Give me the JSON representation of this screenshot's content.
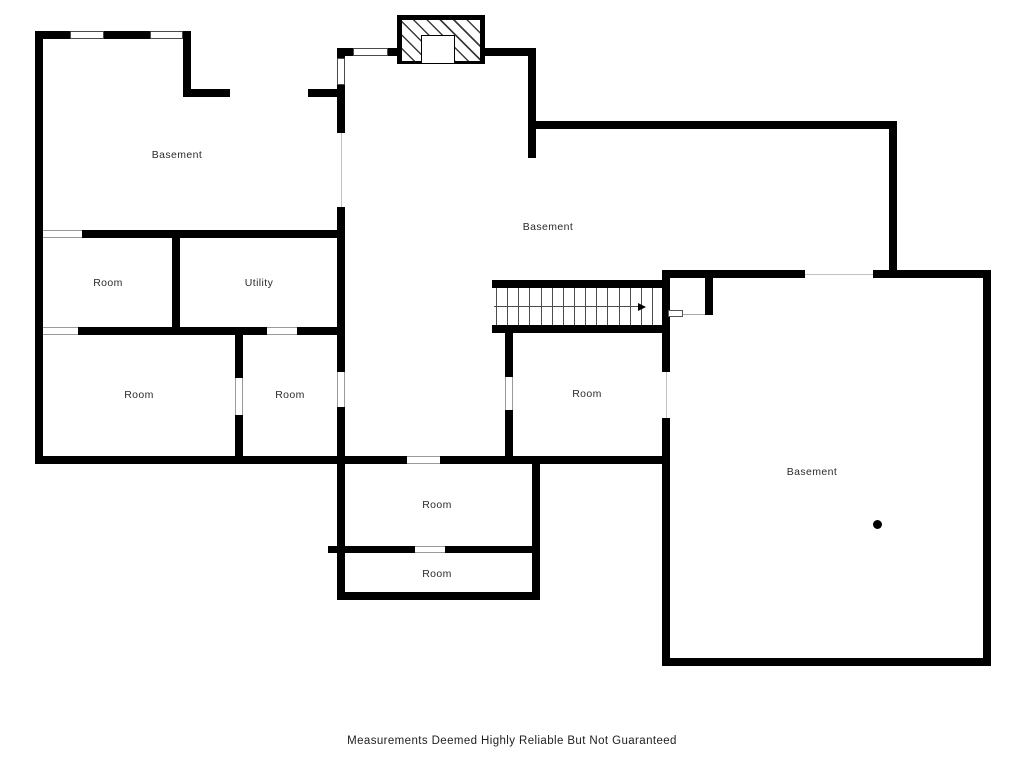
{
  "footer": {
    "text": "Measurements Deemed Highly Reliable But Not Guaranteed",
    "y": 735
  },
  "colors": {
    "wall": "#000000",
    "label": "#2b2b2b",
    "tread": "#4d4d4d"
  },
  "plan": {
    "labels": [
      {
        "text": "Basement",
        "x": 177,
        "y": 155
      },
      {
        "text": "Room",
        "x": 108,
        "y": 283
      },
      {
        "text": "Utility",
        "x": 259,
        "y": 283
      },
      {
        "text": "Room",
        "x": 139,
        "y": 395
      },
      {
        "text": "Room",
        "x": 290,
        "y": 395
      },
      {
        "text": "Basement",
        "x": 548,
        "y": 227
      },
      {
        "text": "Room",
        "x": 587,
        "y": 394
      },
      {
        "text": "Room",
        "x": 437,
        "y": 505
      },
      {
        "text": "Room",
        "x": 437,
        "y": 574
      },
      {
        "text": "Basement",
        "x": 812,
        "y": 472
      }
    ],
    "walls": [
      [
        35,
        31,
        35,
        8
      ],
      [
        104,
        31,
        46,
        8
      ],
      [
        183,
        31,
        8,
        8
      ],
      [
        35,
        31,
        8,
        433
      ],
      [
        183,
        31,
        8,
        66
      ],
      [
        183,
        89,
        47,
        8
      ],
      [
        308,
        89,
        37,
        8
      ],
      [
        337,
        48,
        8,
        10
      ],
      [
        337,
        85,
        8,
        48
      ],
      [
        337,
        207,
        8,
        165
      ],
      [
        337,
        407,
        8,
        193
      ],
      [
        337,
        48,
        16,
        8
      ],
      [
        388,
        48,
        9,
        8
      ],
      [
        485,
        48,
        43,
        8
      ],
      [
        528,
        48,
        8,
        110
      ],
      [
        528,
        121,
        369,
        8
      ],
      [
        889,
        121,
        8,
        157
      ],
      [
        662,
        270,
        143,
        8
      ],
      [
        873,
        270,
        118,
        8
      ],
      [
        983,
        270,
        8,
        396
      ],
      [
        662,
        658,
        329,
        8
      ],
      [
        662,
        270,
        8,
        102
      ],
      [
        662,
        418,
        8,
        248
      ],
      [
        705,
        278,
        8,
        37
      ],
      [
        492,
        280,
        170,
        8
      ],
      [
        492,
        325,
        178,
        8
      ],
      [
        505,
        333,
        8,
        44
      ],
      [
        505,
        410,
        8,
        54
      ],
      [
        35,
        456,
        372,
        8
      ],
      [
        440,
        456,
        230,
        8
      ],
      [
        82,
        230,
        263,
        8
      ],
      [
        172,
        238,
        8,
        96
      ],
      [
        78,
        327,
        189,
        8
      ],
      [
        297,
        327,
        48,
        8
      ],
      [
        235,
        335,
        8,
        43
      ],
      [
        235,
        415,
        8,
        41
      ],
      [
        532,
        464,
        8,
        136
      ],
      [
        328,
        546,
        9,
        7
      ],
      [
        345,
        546,
        70,
        7
      ],
      [
        445,
        546,
        87,
        7
      ],
      [
        337,
        592,
        203,
        8
      ]
    ],
    "openings": [
      {
        "x": 70,
        "y": 31,
        "w": 34,
        "h": 8,
        "kind": "window",
        "dir": "h"
      },
      {
        "x": 150,
        "y": 31,
        "w": 33,
        "h": 8,
        "kind": "window",
        "dir": "h"
      },
      {
        "x": 353,
        "y": 48,
        "w": 35,
        "h": 8,
        "kind": "window",
        "dir": "h"
      },
      {
        "x": 337,
        "y": 58,
        "w": 8,
        "h": 27,
        "kind": "window",
        "dir": "v"
      },
      {
        "x": 337,
        "y": 133,
        "w": 8,
        "h": 74,
        "kind": "line",
        "dir": "v"
      },
      {
        "x": 337,
        "y": 372,
        "w": 8,
        "h": 35,
        "kind": "door",
        "dir": "v"
      },
      {
        "x": 805,
        "y": 270,
        "w": 68,
        "h": 8,
        "kind": "line",
        "dir": "h"
      },
      {
        "x": 662,
        "y": 372,
        "w": 8,
        "h": 46,
        "kind": "line",
        "dir": "v"
      },
      {
        "x": 505,
        "y": 377,
        "w": 8,
        "h": 33,
        "kind": "door",
        "dir": "v"
      },
      {
        "x": 407,
        "y": 456,
        "w": 33,
        "h": 8,
        "kind": "door",
        "dir": "h"
      },
      {
        "x": 43,
        "y": 230,
        "w": 39,
        "h": 8,
        "kind": "door",
        "dir": "h"
      },
      {
        "x": 43,
        "y": 327,
        "w": 35,
        "h": 8,
        "kind": "door",
        "dir": "h"
      },
      {
        "x": 267,
        "y": 327,
        "w": 30,
        "h": 8,
        "kind": "door",
        "dir": "h"
      },
      {
        "x": 235,
        "y": 378,
        "w": 8,
        "h": 37,
        "kind": "door",
        "dir": "v"
      },
      {
        "x": 415,
        "y": 546,
        "w": 30,
        "h": 7,
        "kind": "door",
        "dir": "h"
      }
    ],
    "stairs": {
      "x": 492,
      "y": 288,
      "w": 170,
      "h": 37,
      "treads": 15,
      "tx1": 4,
      "tx2": 160
    },
    "arrow": {
      "x1": 494,
      "y": 306,
      "x2": 638,
      "tip": 647
    },
    "fireplace": {
      "x": 397,
      "y": 15,
      "w": 88,
      "h": 49,
      "fbx": 421,
      "fby": 35,
      "fbw": 34,
      "fbh": 28
    },
    "door_leaf": {
      "x": 668,
      "y": 310,
      "w": 15,
      "h": 7,
      "line_x2": 705
    },
    "dot": {
      "x": 877,
      "y": 524,
      "r": 4.5
    }
  }
}
